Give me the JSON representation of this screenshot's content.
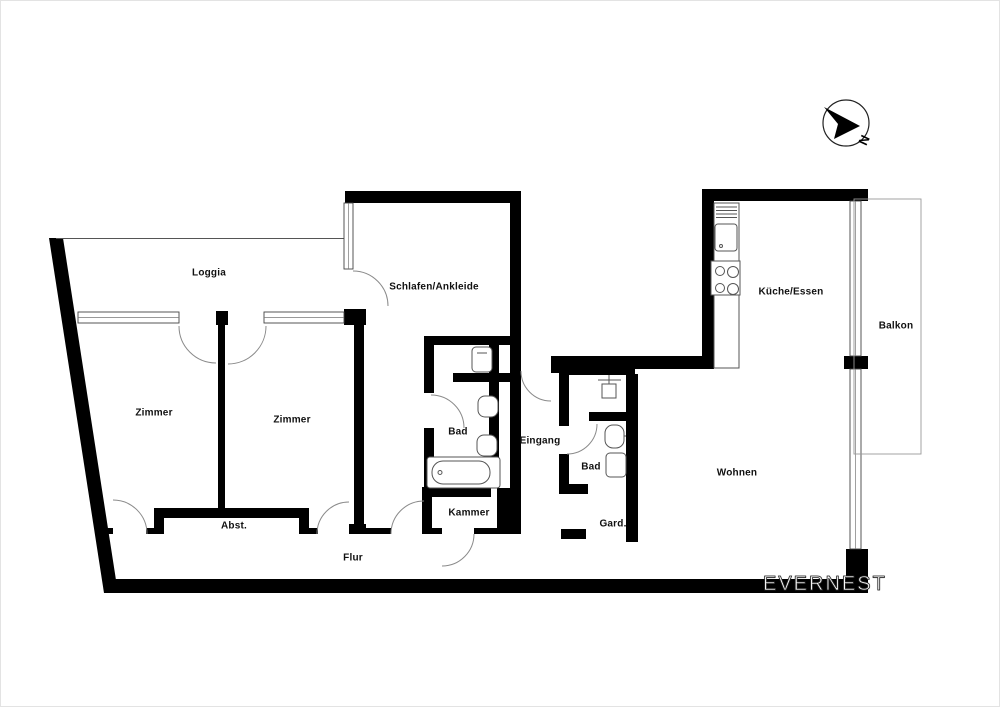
{
  "title": "Apartment floor plan",
  "colors": {
    "wall": "#000000",
    "background": "#ffffff",
    "line": "#555555",
    "watermark_text": "#ffffff"
  },
  "rooms": [
    {
      "id": "loggia",
      "label": "Loggia"
    },
    {
      "id": "schlafen",
      "label": "Schlafen/Ankleide"
    },
    {
      "id": "kueche",
      "label": "Küche/Essen"
    },
    {
      "id": "balkon",
      "label": "Balkon"
    },
    {
      "id": "zimmer1",
      "label": "Zimmer"
    },
    {
      "id": "zimmer2",
      "label": "Zimmer"
    },
    {
      "id": "bad1",
      "label": "Bad"
    },
    {
      "id": "eingang",
      "label": "Eingang"
    },
    {
      "id": "bad2",
      "label": "Bad"
    },
    {
      "id": "wohnen",
      "label": "Wohnen"
    },
    {
      "id": "abst",
      "label": "Abst."
    },
    {
      "id": "kammer",
      "label": "Kammer"
    },
    {
      "id": "gard",
      "label": "Gard."
    },
    {
      "id": "flur",
      "label": "Flur"
    }
  ],
  "compass": {
    "north_label": "N"
  },
  "watermark": {
    "text": "EVERNEST"
  }
}
